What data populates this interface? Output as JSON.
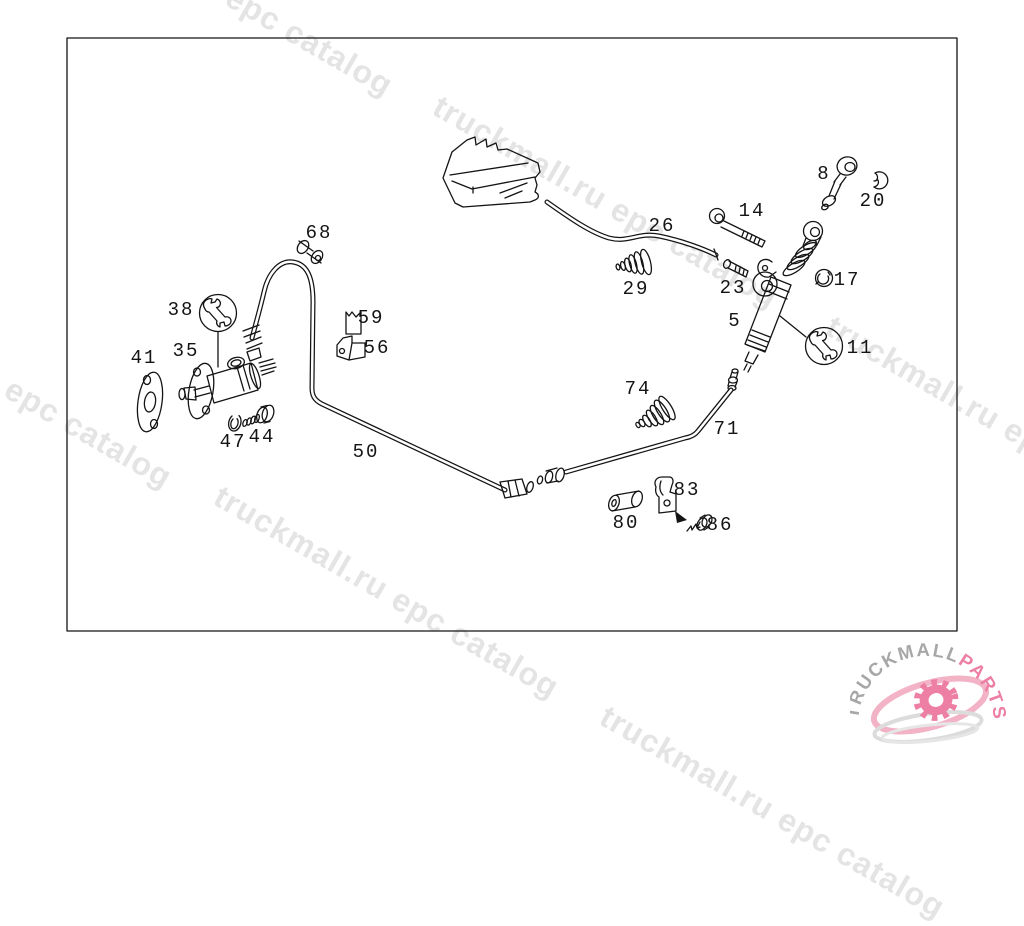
{
  "watermark": {
    "text": "truckmall.ru epc catalog",
    "color": "#e4e4e4"
  },
  "logo": {
    "text_gray": "TRUCKMALL",
    "text_pink": "PARTS",
    "gray_color": "#a7a7a7",
    "pink_color": "#ec7fa3",
    "pink_light": "#f3b3c6",
    "swoosh_gray": "#dcdcdc"
  },
  "diagram": {
    "stroke_color": "#141414",
    "background": "#ffffff",
    "callouts": [
      "8",
      "20",
      "14",
      "26",
      "29",
      "23",
      "17",
      "5",
      "11",
      "68",
      "59",
      "56",
      "38",
      "35",
      "41",
      "47",
      "44",
      "50",
      "74",
      "71",
      "83",
      "80",
      "86"
    ]
  }
}
